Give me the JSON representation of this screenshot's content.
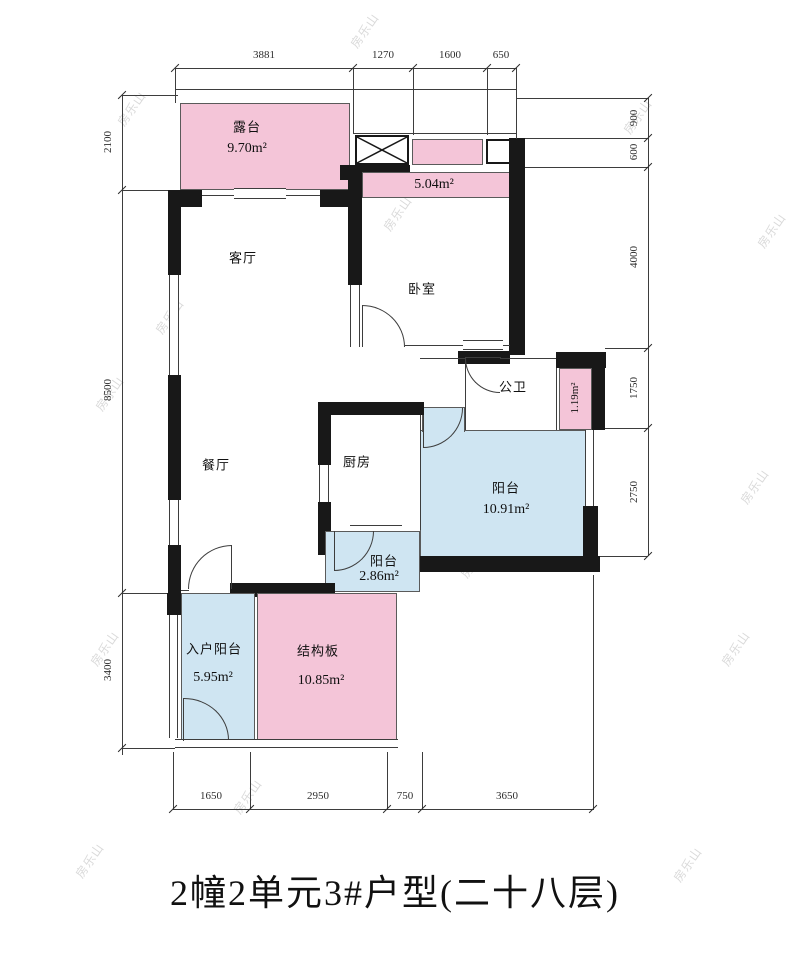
{
  "title": "2幢2单元3#户型(二十八层)",
  "watermark": "房乐山",
  "colors": {
    "pink": "#F4C5D8",
    "blue": "#CFE5F2",
    "wall": "#181818",
    "line": "#3d3d3d"
  },
  "rooms": {
    "terrace": {
      "name": "露台",
      "area": "9.70m²"
    },
    "strip_504": {
      "area": "5.04m²"
    },
    "living": {
      "name": "客厅"
    },
    "bedroom": {
      "name": "卧室"
    },
    "bath": {
      "name": "公卫"
    },
    "duct": {
      "area": "1.19m²"
    },
    "kitchen": {
      "name": "厨房"
    },
    "dining": {
      "name": "餐厅"
    },
    "balcony_main": {
      "name": "阳台",
      "area": "10.91m²"
    },
    "balcony_small": {
      "name": "阳台",
      "area": "2.86m²"
    },
    "entry_balcony": {
      "name": "入户阳台",
      "area": "5.95m²"
    },
    "slab": {
      "name": "结构板",
      "area": "10.85m²"
    }
  },
  "dimensions": {
    "top": [
      "3881",
      "1270",
      "1600",
      "650"
    ],
    "left": [
      "2100",
      "8500",
      "3400"
    ],
    "right": [
      "900",
      "600",
      "4000",
      "1750",
      "2750"
    ],
    "bottom": [
      "1650",
      "2950",
      "750",
      "3650"
    ]
  }
}
